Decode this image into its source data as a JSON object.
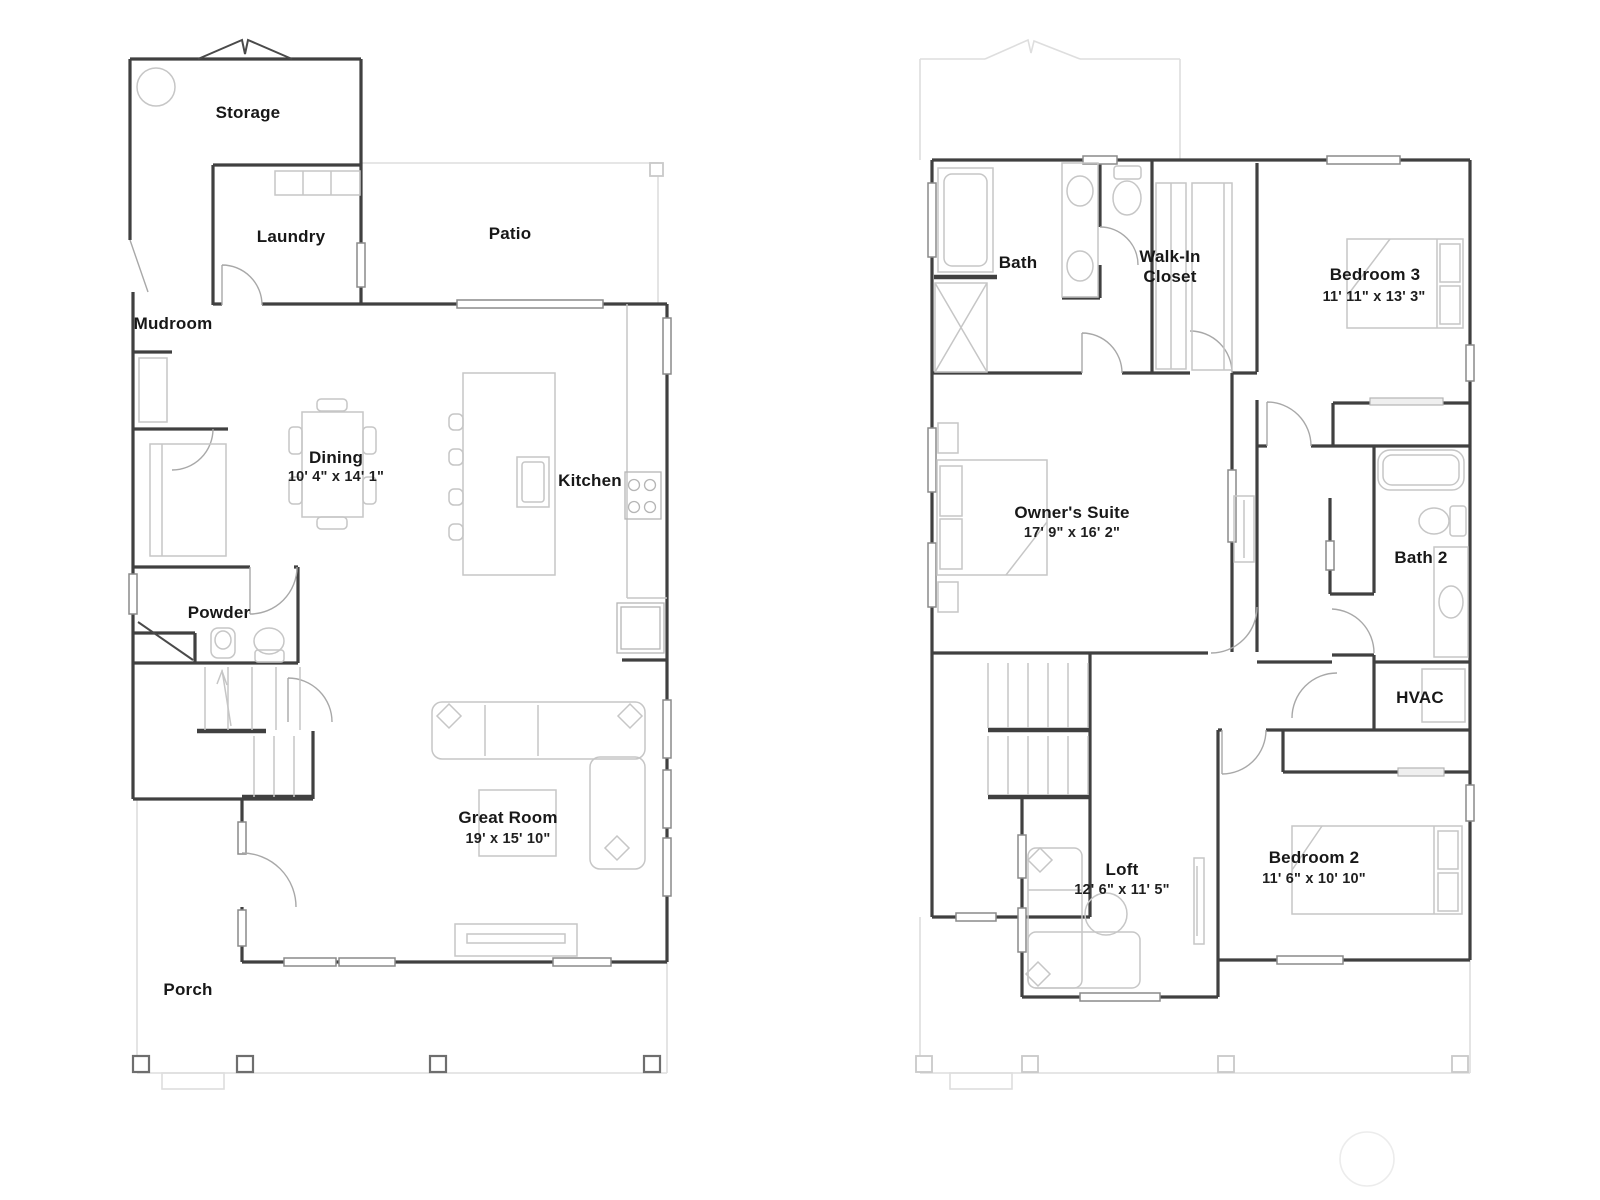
{
  "floor1": {
    "storage": {
      "label": "Storage"
    },
    "laundry": {
      "label": "Laundry"
    },
    "patio": {
      "label": "Patio"
    },
    "mudroom": {
      "label": "Mudroom"
    },
    "dining": {
      "label": "Dining",
      "dims": "10' 4\" x 14' 1\""
    },
    "kitchen": {
      "label": "Kitchen"
    },
    "powder": {
      "label": "Powder"
    },
    "great_room": {
      "label": "Great Room",
      "dims": "19' x 15' 10\""
    },
    "porch": {
      "label": "Porch"
    }
  },
  "floor2": {
    "bath": {
      "label": "Bath"
    },
    "walk_in_closet": {
      "label": "Walk-In Closet",
      "label_lines": [
        "Walk-In",
        "Closet"
      ]
    },
    "bedroom3": {
      "label": "Bedroom 3",
      "dims": "11' 11\" x 13' 3\""
    },
    "owners_suite": {
      "label": "Owner's Suite",
      "dims": "17' 9\" x 16' 2\""
    },
    "bath2": {
      "label": "Bath 2"
    },
    "hvac": {
      "label": "HVAC"
    },
    "loft": {
      "label": "Loft",
      "dims": "12' 6\" x 11' 5\""
    },
    "bedroom2": {
      "label": "Bedroom 2",
      "dims": "11' 6\" x 10' 10\""
    }
  },
  "colors": {
    "wall": "#404040",
    "furniture": "#c6c6c6",
    "faint_outline": "#dedede",
    "label_text": "#181818"
  }
}
